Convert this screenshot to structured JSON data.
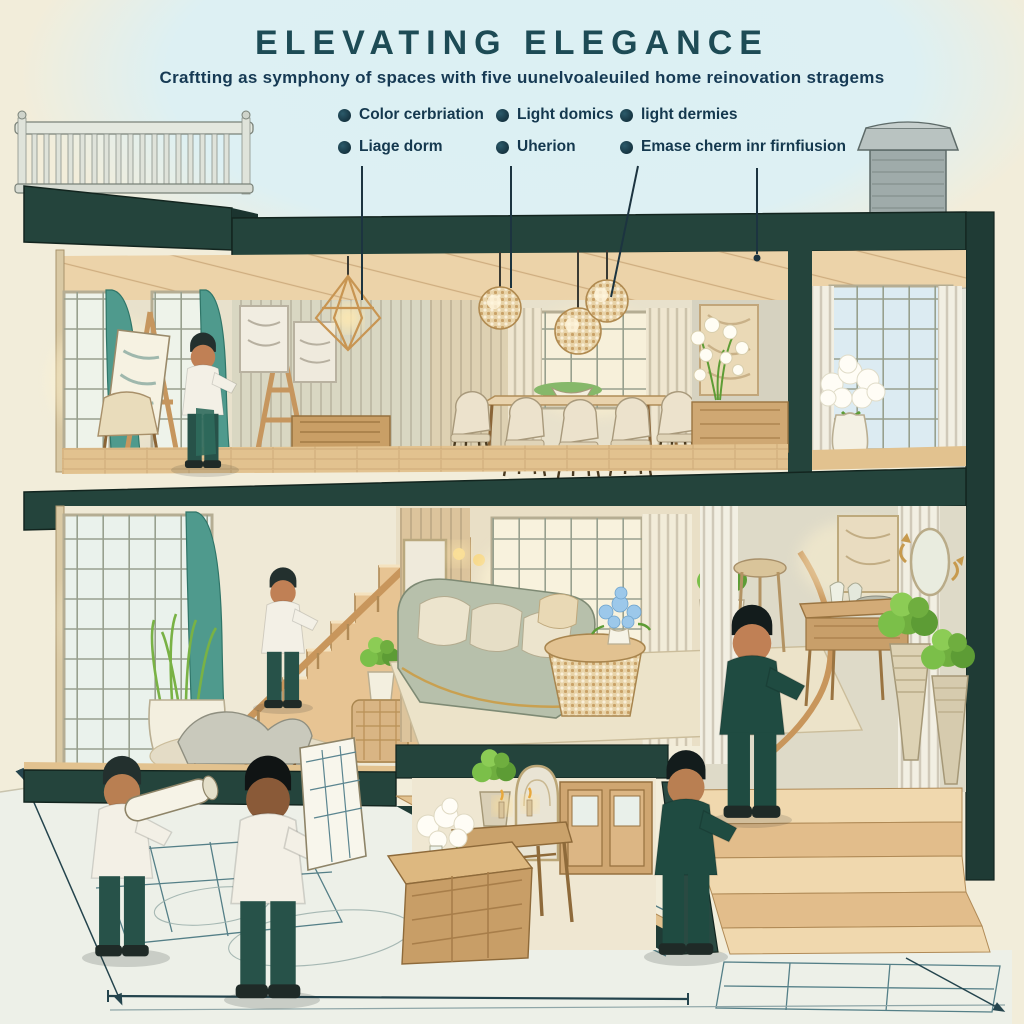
{
  "header": {
    "title": "ELEVATING ELEGANCE",
    "subtitle": "Craftting as symphony of spaces with five uunelvoaleuiled home reinovation stragems"
  },
  "bullets": {
    "row1": [
      {
        "label": "Color cerbriation"
      },
      {
        "label": "Light domics"
      },
      {
        "label": "light dermies"
      }
    ],
    "row2": [
      {
        "label": "Liage dorm"
      },
      {
        "label": "Uherion"
      },
      {
        "label": "Emase cherm inr firnfiusion"
      }
    ]
  },
  "icons": {
    "bullet": "bullet-dot-icon"
  },
  "palette": {
    "background": "#f2edda",
    "sky": "#ddf0f3",
    "structure_teal": "#24443c",
    "structure_teal_dark": "#1b342f",
    "title_text": "#1d4b55",
    "body_text": "#14384e",
    "wood_light": "#ecd3a9",
    "wood_mid": "#d3a878",
    "curtain_teal": "#4f9a8d",
    "cream_fabric": "#ece2cc",
    "blueprint_line": "#2f6370",
    "accent_gold": "#c89552",
    "plant_green": "#6fae3f",
    "suit_teal": "#1f4b41"
  }
}
